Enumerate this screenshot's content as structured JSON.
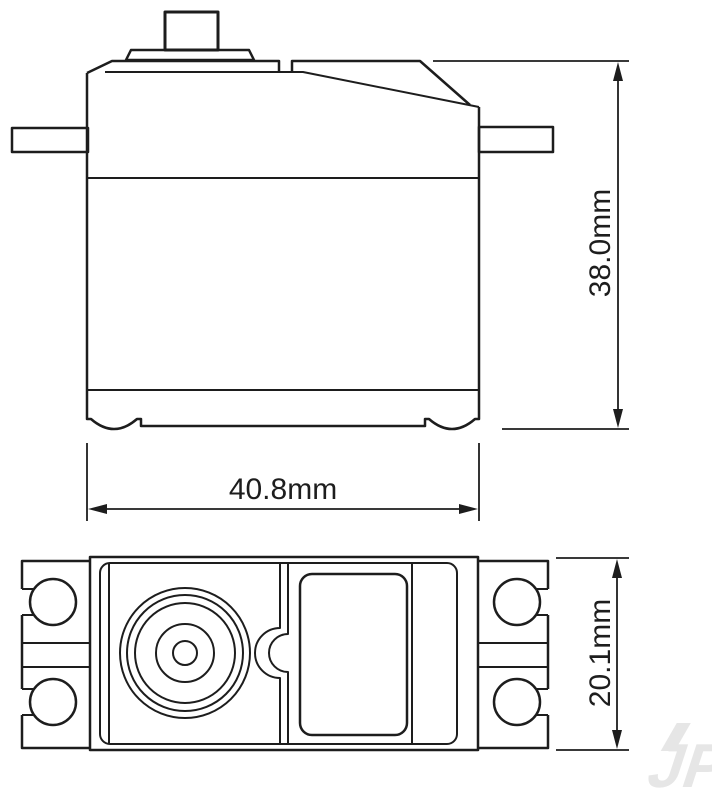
{
  "page": {
    "background": "#ffffff"
  },
  "drawing": {
    "type": "technical-dimensional-drawing",
    "subject": "servo motor, side view and top view with dimensions",
    "line_color": "#1d1d1d",
    "dimensions": {
      "body_height": {
        "label": "38.0mm",
        "view": "side",
        "orientation": "vertical"
      },
      "body_width": {
        "label": "40.8mm",
        "view": "side",
        "orientation": "horizontal"
      },
      "body_depth": {
        "label": "20.1mm",
        "view": "top",
        "orientation": "vertical"
      }
    },
    "watermark": {
      "text": "JP",
      "color": "#e6e6e6"
    }
  }
}
